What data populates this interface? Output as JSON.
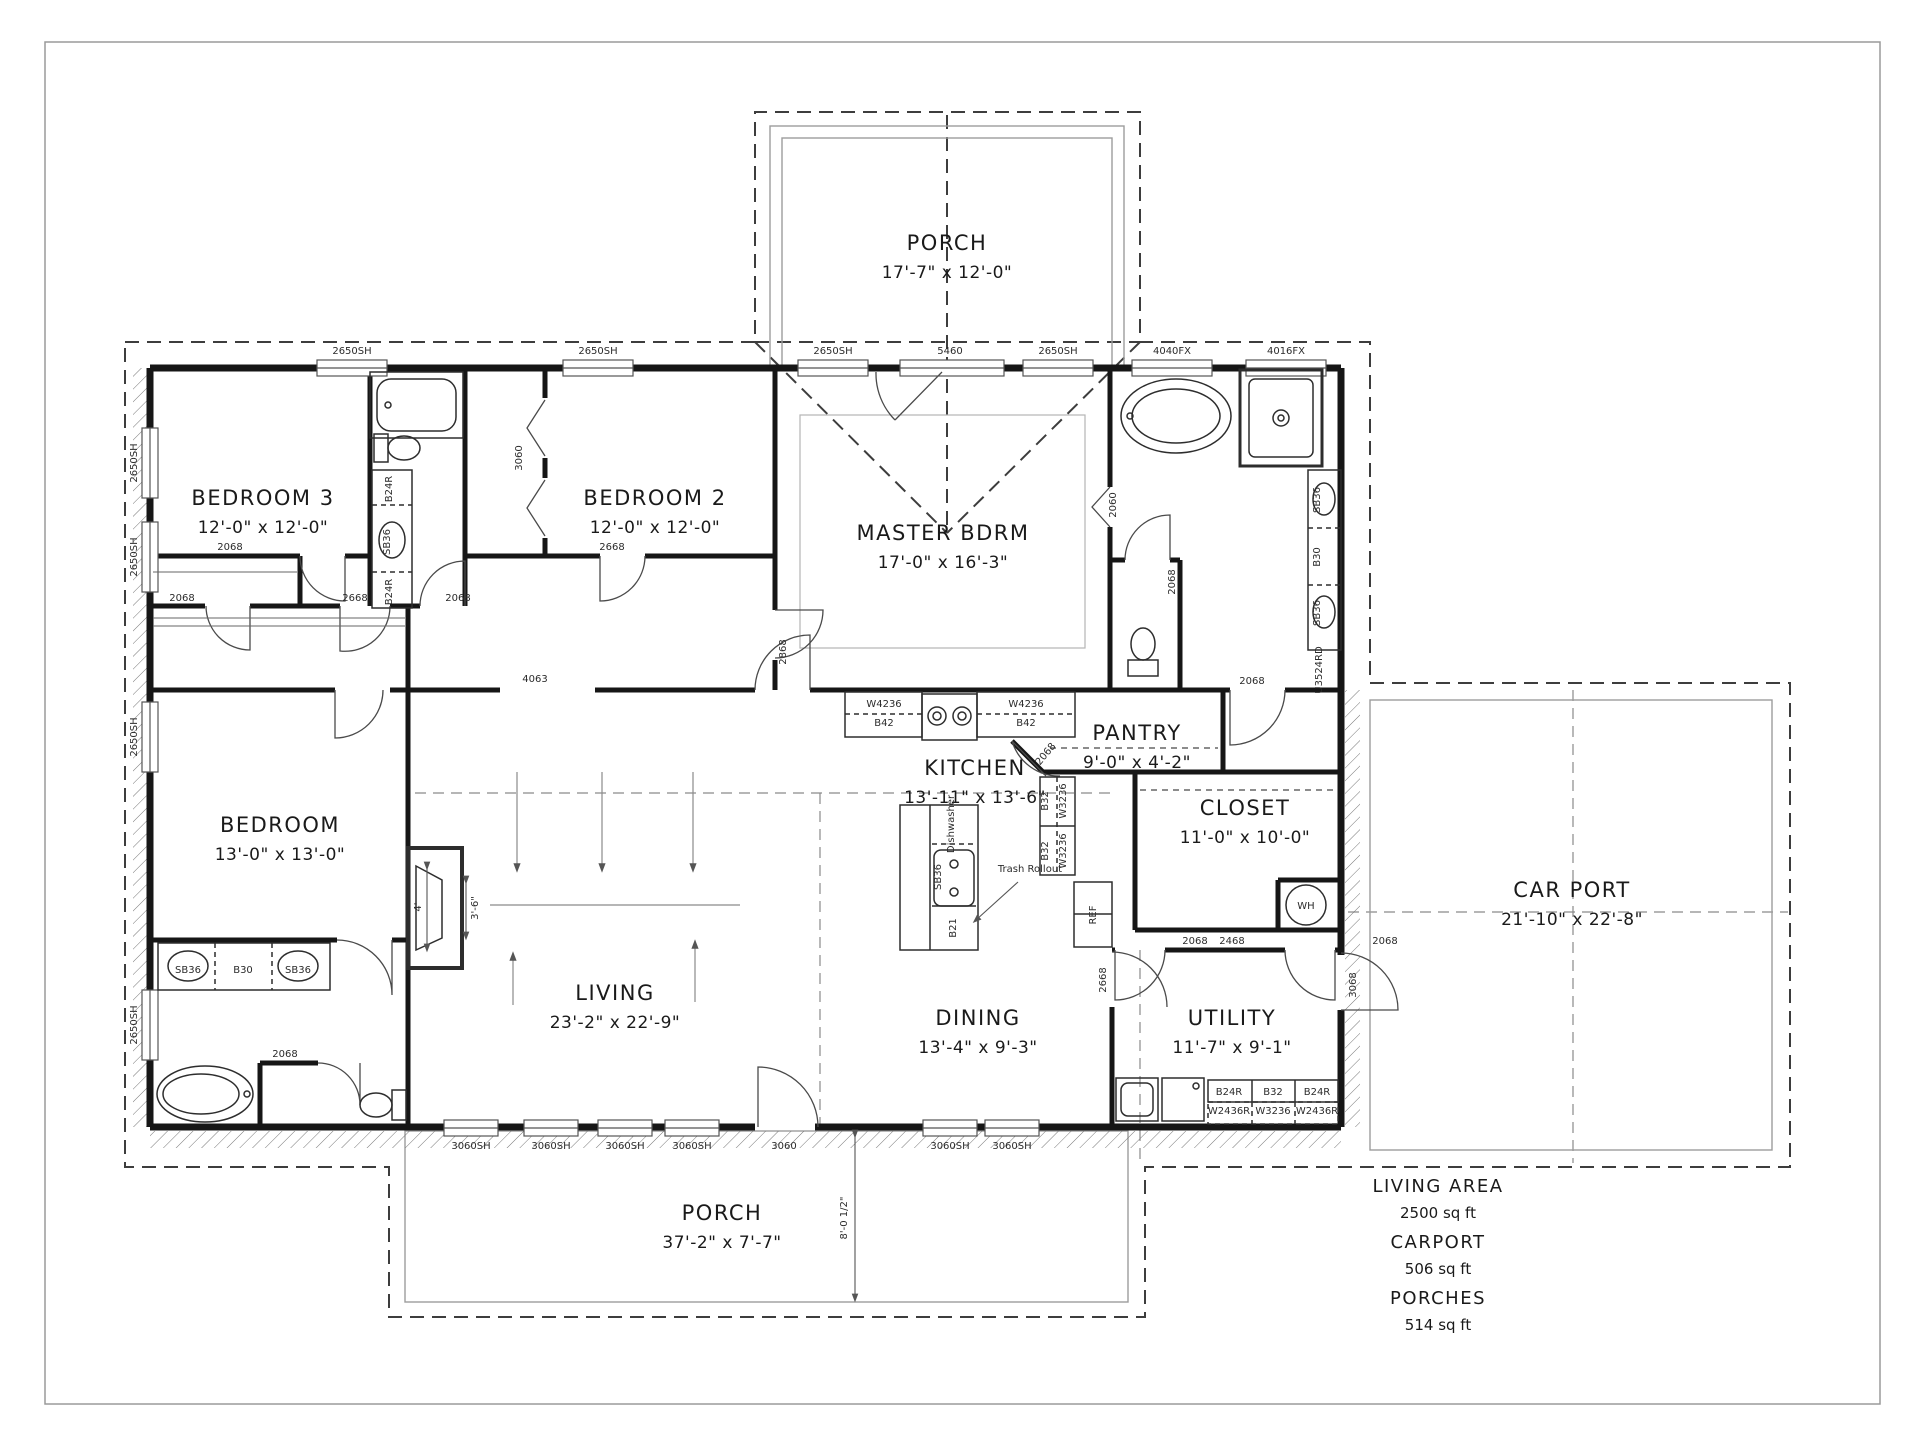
{
  "drawing": {
    "type": "residential floor plan",
    "background": "#ffffff",
    "line_color": "#1a1a1a"
  },
  "rooms": [
    {
      "name": "PORCH",
      "dims": "17'-7\" x 12'-0\"",
      "x": 947,
      "y": 250
    },
    {
      "name": "BEDROOM 3",
      "dims": "12'-0\" x 12'-0\"",
      "x": 263,
      "y": 505
    },
    {
      "name": "BEDROOM 2",
      "dims": "12'-0\" x 12'-0\"",
      "x": 655,
      "y": 505
    },
    {
      "name": "MASTER BDRM",
      "dims": "17'-0\" x 16'-3\"",
      "x": 943,
      "y": 540
    },
    {
      "name": "BEDROOM",
      "dims": "13'-0\" x 13'-0\"",
      "x": 280,
      "y": 832
    },
    {
      "name": "KITCHEN",
      "dims": "13'-11\" x 13'-6\"",
      "x": 975,
      "y": 775
    },
    {
      "name": "PANTRY",
      "dims": "9'-0\" x 4'-2\"",
      "x": 1137,
      "y": 740
    },
    {
      "name": "CLOSET",
      "dims": "11'-0\" x 10'-0\"",
      "x": 1245,
      "y": 815
    },
    {
      "name": "CAR PORT",
      "dims": "21'-10\" x 22'-8\"",
      "x": 1572,
      "y": 897
    },
    {
      "name": "LIVING",
      "dims": "23'-2\" x 22'-9\"",
      "x": 615,
      "y": 1000
    },
    {
      "name": "DINING",
      "dims": "13'-4\" x 9'-3\"",
      "x": 978,
      "y": 1025
    },
    {
      "name": "UTILITY",
      "dims": "11'-7\" x 9'-1\"",
      "x": 1232,
      "y": 1025
    },
    {
      "name": "PORCH",
      "dims": "37'-2\" x 7'-7\"",
      "x": 722,
      "y": 1220
    }
  ],
  "stats": [
    {
      "label": "LIVING AREA",
      "value": "2500 sq ft"
    },
    {
      "label": "CARPORT",
      "value": "506 sq ft"
    },
    {
      "label": "PORCHES",
      "value": "514 sq ft"
    }
  ],
  "annotations": [
    {
      "t": "2650SH",
      "x": 352,
      "y": 354
    },
    {
      "t": "2650SH",
      "x": 598,
      "y": 354
    },
    {
      "t": "2650SH",
      "x": 833,
      "y": 354
    },
    {
      "t": "5460",
      "x": 950,
      "y": 354
    },
    {
      "t": "2650SH",
      "x": 1058,
      "y": 354
    },
    {
      "t": "4040FX",
      "x": 1172,
      "y": 354
    },
    {
      "t": "4016FX",
      "x": 1286,
      "y": 354
    },
    {
      "t": "2650SH",
      "x": 137,
      "y": 463,
      "r": -90
    },
    {
      "t": "2650SH",
      "x": 137,
      "y": 557,
      "r": -90
    },
    {
      "t": "2650SH",
      "x": 137,
      "y": 737,
      "r": -90
    },
    {
      "t": "2650SH",
      "x": 137,
      "y": 1025,
      "r": -90
    },
    {
      "t": "3060SH",
      "x": 471,
      "y": 1149
    },
    {
      "t": "3060SH",
      "x": 551,
      "y": 1149
    },
    {
      "t": "3060SH",
      "x": 625,
      "y": 1149
    },
    {
      "t": "3060SH",
      "x": 692,
      "y": 1149
    },
    {
      "t": "3060",
      "x": 784,
      "y": 1149
    },
    {
      "t": "3060SH",
      "x": 950,
      "y": 1149
    },
    {
      "t": "3060SH",
      "x": 1012,
      "y": 1149
    },
    {
      "t": "2068",
      "x": 230,
      "y": 550
    },
    {
      "t": "2668",
      "x": 612,
      "y": 550
    },
    {
      "t": "2068",
      "x": 182,
      "y": 601
    },
    {
      "t": "2668",
      "x": 355,
      "y": 601
    },
    {
      "t": "2068",
      "x": 458,
      "y": 601
    },
    {
      "t": "2868",
      "x": 786,
      "y": 652,
      "r": -90
    },
    {
      "t": "4063",
      "x": 535,
      "y": 682
    },
    {
      "t": "2060",
      "x": 1116,
      "y": 505,
      "r": -90
    },
    {
      "t": "2068",
      "x": 1175,
      "y": 582,
      "r": -90
    },
    {
      "t": "2068",
      "x": 1252,
      "y": 684
    },
    {
      "t": "2068",
      "x": 1048,
      "y": 756,
      "r": -50
    },
    {
      "t": "2668",
      "x": 1106,
      "y": 980,
      "r": -90
    },
    {
      "t": "2068",
      "x": 1195,
      "y": 944
    },
    {
      "t": "2468",
      "x": 1232,
      "y": 944
    },
    {
      "t": "2068",
      "x": 1385,
      "y": 944
    },
    {
      "t": "3068",
      "x": 1356,
      "y": 985,
      "r": -90
    },
    {
      "t": "3060",
      "x": 522,
      "y": 458,
      "r": -90
    },
    {
      "t": "2068",
      "x": 285,
      "y": 1057
    },
    {
      "t": "W4236",
      "x": 884,
      "y": 707,
      "s": 9
    },
    {
      "t": "B42",
      "x": 884,
      "y": 726,
      "s": 9
    },
    {
      "t": "W4236",
      "x": 1026,
      "y": 707,
      "s": 9
    },
    {
      "t": "B42",
      "x": 1026,
      "y": 726,
      "s": 9
    },
    {
      "t": "B32",
      "x": 1048,
      "y": 801,
      "r": -90,
      "s": 9
    },
    {
      "t": "W3236",
      "x": 1066,
      "y": 801,
      "r": -90,
      "s": 9
    },
    {
      "t": "B32",
      "x": 1048,
      "y": 851,
      "r": -90,
      "s": 9
    },
    {
      "t": "W3236",
      "x": 1066,
      "y": 851,
      "r": -90,
      "s": 9
    },
    {
      "t": "Dishwasher",
      "x": 954,
      "y": 824,
      "r": -90,
      "s": 8
    },
    {
      "t": "SB36",
      "x": 941,
      "y": 877,
      "r": -90,
      "s": 9
    },
    {
      "t": "B21",
      "x": 956,
      "y": 928,
      "r": -90,
      "s": 9
    },
    {
      "t": "Trash Rollout",
      "x": 1030,
      "y": 872,
      "s": 10
    },
    {
      "t": "REF",
      "x": 1096,
      "y": 915,
      "r": -90,
      "s": 9
    },
    {
      "t": "B24R",
      "x": 392,
      "y": 489,
      "r": -90,
      "s": 9
    },
    {
      "t": "SB36",
      "x": 390,
      "y": 542,
      "r": -90,
      "s": 9
    },
    {
      "t": "B24R",
      "x": 392,
      "y": 592,
      "r": -90,
      "s": 9
    },
    {
      "t": "SB36",
      "x": 188,
      "y": 973,
      "s": 9
    },
    {
      "t": "B30",
      "x": 243,
      "y": 973,
      "s": 9
    },
    {
      "t": "SB36",
      "x": 298,
      "y": 973,
      "s": 9
    },
    {
      "t": "SB36",
      "x": 1320,
      "y": 500,
      "r": -90,
      "s": 9
    },
    {
      "t": "B30",
      "x": 1320,
      "y": 557,
      "r": -90,
      "s": 9
    },
    {
      "t": "SB36",
      "x": 1320,
      "y": 613,
      "r": -90,
      "s": 9
    },
    {
      "t": "U3524RD",
      "x": 1322,
      "y": 670,
      "r": -90,
      "s": 8
    },
    {
      "t": "B24R",
      "x": 1229,
      "y": 1095,
      "s": 8
    },
    {
      "t": "B32",
      "x": 1273,
      "y": 1095,
      "s": 8
    },
    {
      "t": "B24R",
      "x": 1317,
      "y": 1095,
      "s": 8
    },
    {
      "t": "W2436R",
      "x": 1229,
      "y": 1114,
      "s": 8
    },
    {
      "t": "W3236",
      "x": 1273,
      "y": 1114,
      "s": 8
    },
    {
      "t": "W2436R",
      "x": 1317,
      "y": 1114,
      "s": 8
    },
    {
      "t": "WH",
      "x": 1306,
      "y": 909,
      "s": 10
    },
    {
      "t": "4'",
      "x": 421,
      "y": 907,
      "r": -90,
      "s": 13
    },
    {
      "t": "3'-6\"",
      "x": 478,
      "y": 908,
      "r": -90,
      "s": 13
    },
    {
      "t": "8'-0 1/2\"",
      "x": 847,
      "y": 1218,
      "r": -90,
      "s": 13
    }
  ]
}
